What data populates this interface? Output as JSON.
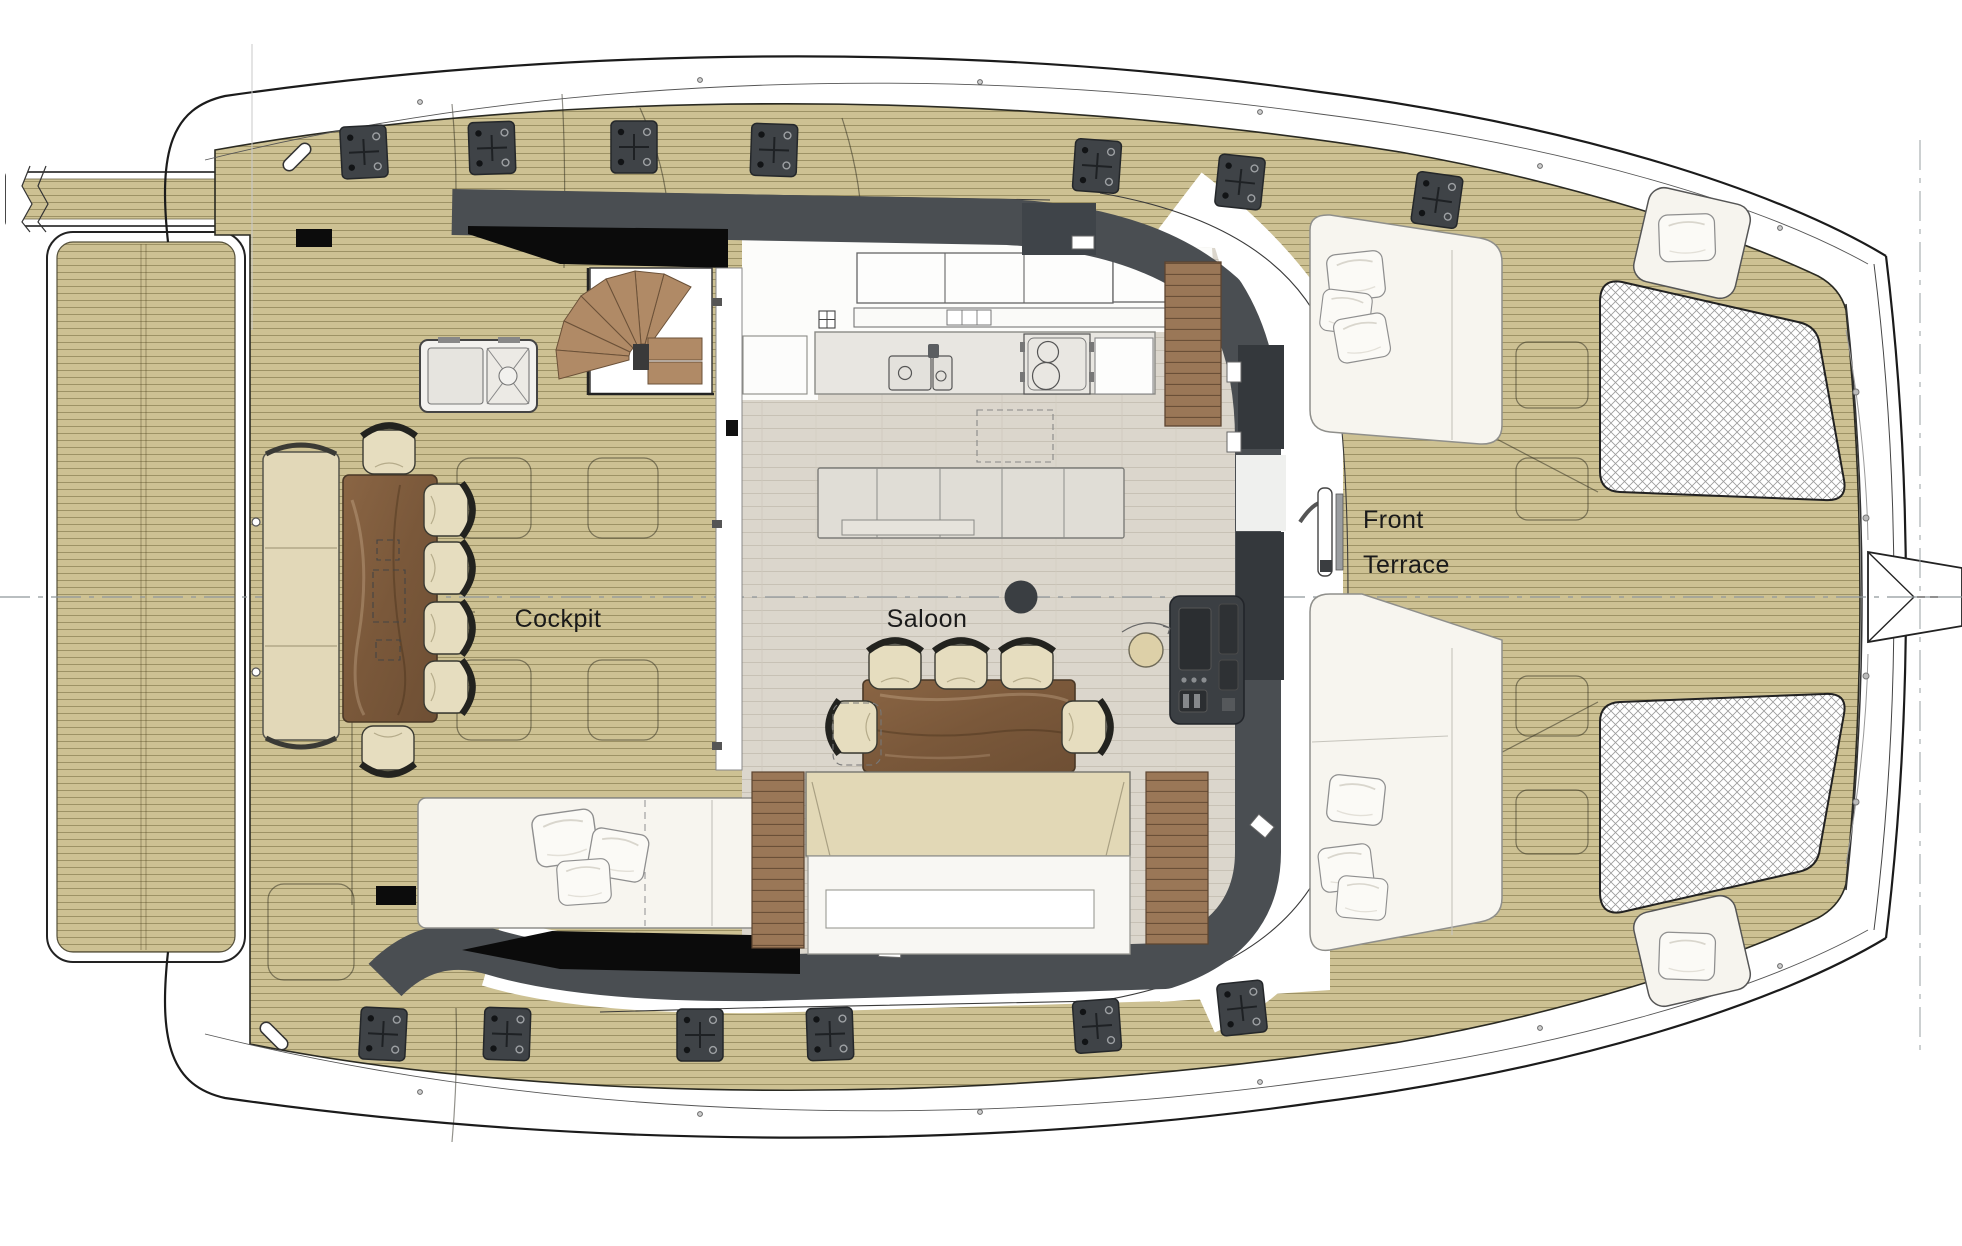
{
  "document": {
    "type": "catamaran-deck-plan",
    "view": "top-down main deck layout drawing"
  },
  "labels": {
    "cockpit": "Cockpit",
    "saloon": "Saloon",
    "front_terrace_line1": "Front",
    "front_terrace_line2": "Terrace"
  },
  "rooms": [
    {
      "name": "Cockpit"
    },
    {
      "name": "Saloon"
    },
    {
      "name": "Front Terrace"
    }
  ],
  "palette": {
    "deck_teak": "#cdc193",
    "deck_plank_line": "#9d9265",
    "hull_outline": "#1b1b1b",
    "coachroof_band": "#4a4e52",
    "glass_black": "#0b0b0b",
    "saloon_floor": "#dbd6cc",
    "counter_gray": "#e8e6e1",
    "cabinet_white": "#fcfcfa",
    "furniture_wood": "#826042",
    "step_wood": "#b08a66",
    "cushion_tan": "#e2d8b8",
    "sunpad_white": "#f7f5ef",
    "trampoline_line": "#9b9b9b",
    "fitting_gray": "#3f4347",
    "console_gray": "#3b3f43",
    "construction_line": "#9aa0a3"
  },
  "furniture_inventory": [
    "aft swim platform",
    "passerelle boom",
    "cockpit bench sofa",
    "cockpit dining table",
    "cockpit chairs x6",
    "outdoor sink and grill unit",
    "spiral staircase",
    "cockpit sunpad",
    "galley overhead cabinets",
    "galley counter with sink and stove",
    "island sideboard",
    "saloon dining table",
    "saloon chairs x5 plus folding position",
    "saloon sofa",
    "navigation console",
    "swivel stool",
    "mast post",
    "front terrace sunpads x2",
    "bow seat pods x2",
    "bow trampolines x2",
    "deck mooring fittings x13",
    "scatter pillows x11"
  ]
}
